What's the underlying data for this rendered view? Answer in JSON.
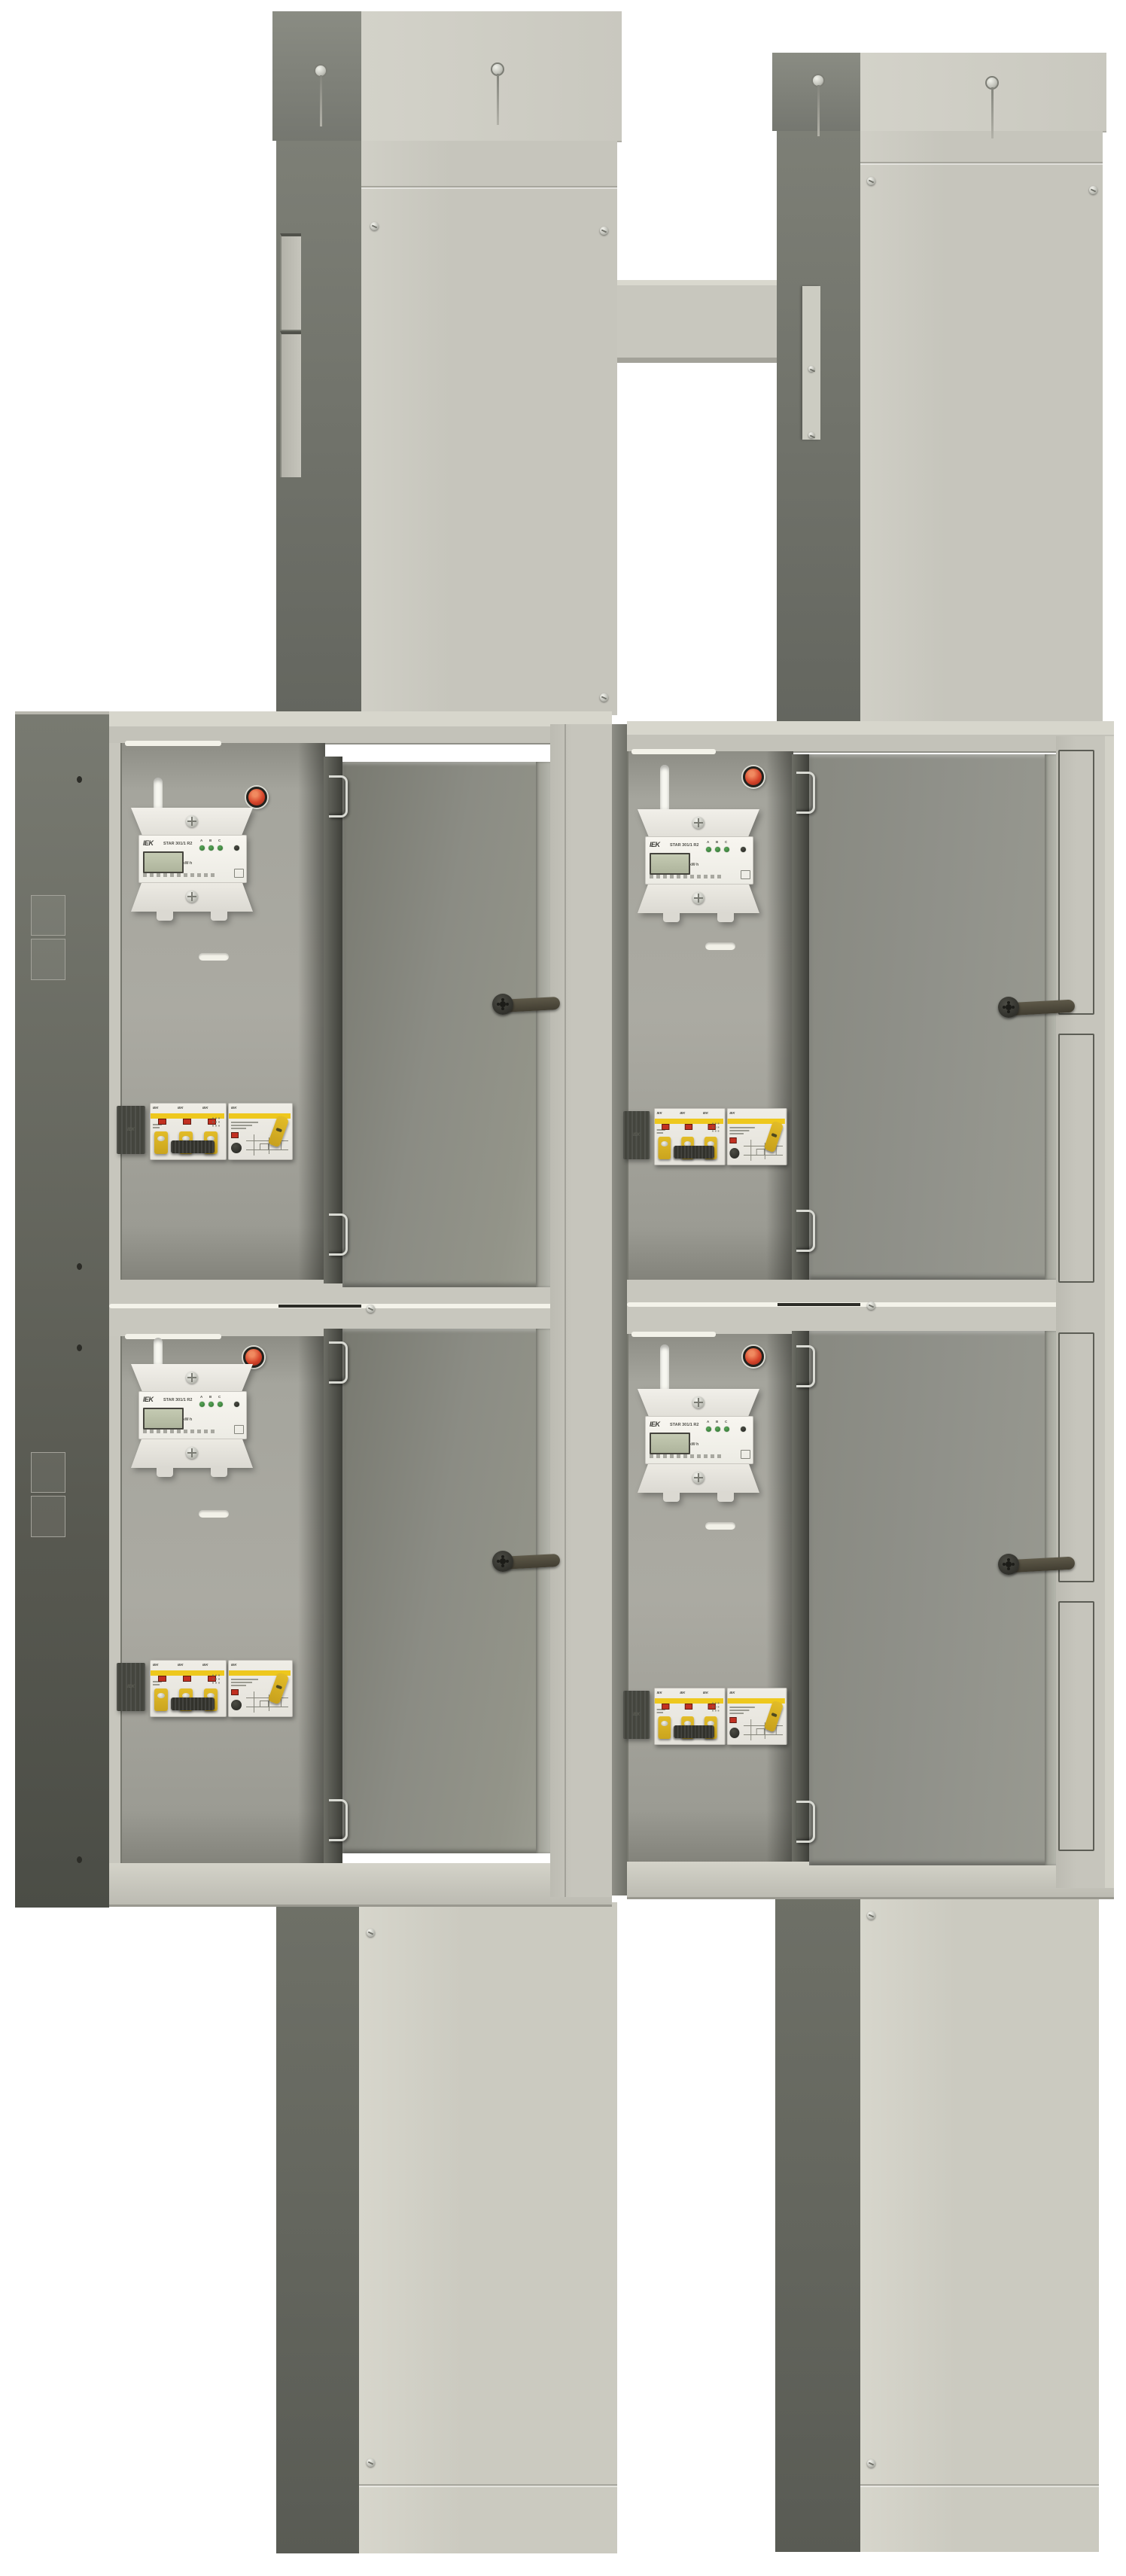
{
  "scene": {
    "background": "#ffffff"
  },
  "colors": {
    "column_front": "#c6c5bc",
    "column_side_dark": "#6e7067",
    "cap": "#d3d2c9",
    "cabinet_side_dark": "#5a5c54",
    "interior_back": "#a7a79f",
    "door_inner": "#8b8c84",
    "door_edge": "#b5b6ad",
    "divider": "#c8c7be",
    "filler_panel": "#c4c3ba",
    "slot_white": "#f6f6ef",
    "pilot_red": "#d6452b",
    "breaker_yellow": "#eec81d",
    "breaker_body": "#eae8e1",
    "terminal_cover_dark": "#44453e",
    "lcd_green": "#b6bca4",
    "metal": "#d9dad3"
  },
  "meter": {
    "brand": "IEK",
    "model": "STAR 301/1 R2",
    "kwh_label": "kW·h",
    "phase_labels": [
      "A",
      "B",
      "C"
    ],
    "display_value": ""
  },
  "breaker": {
    "brand": "IEK"
  },
  "icons": {
    "pilot-light-icon": "●",
    "screw-icon": "⊙",
    "keyhole-screw-icon": "⍘",
    "hinge-clip-icon": "⊃",
    "latch-icon": "⊷",
    "vent-slot-icon": "▭",
    "cable-slot-icon": "▯"
  }
}
